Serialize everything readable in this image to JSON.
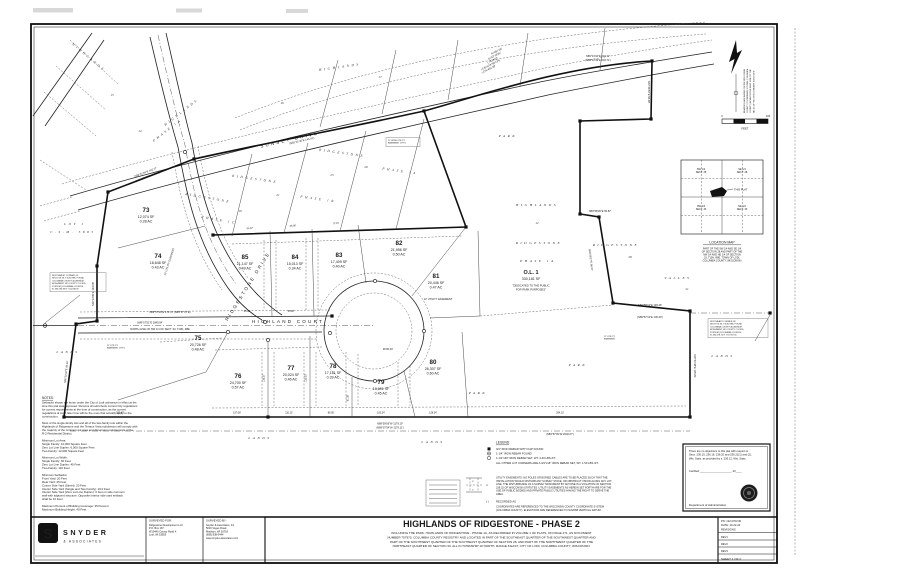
{
  "doc": {
    "type_label": "Final Plat Survey Sheet"
  },
  "title_block": {
    "logo": {
      "letter": "S",
      "name": "SNYDER",
      "sub": "& ASSOCIATES"
    },
    "surveyed_for": {
      "label": "SURVEYED FOR:",
      "lines": [
        "Ridgestone Development LLC",
        "P.O.  Box 167",
        "W10440 County Road K",
        "Lodi, WI 53555"
      ]
    },
    "surveyed_by": {
      "label": "SURVEYED BY:",
      "lines": [
        "Snyder & Associates, Inc.",
        "5010 Voges Road",
        "Madison, WI 53718",
        "(608) 838-0444",
        "www.snyder-associates.com"
      ]
    },
    "title": "HIGHLANDS OF RIDGESTONE - PHASE 2",
    "description_lines": [
      "INCLUDING THE PARK, HIGHLANDS OF RIDGESTONE - PHASE 1A, AS RECORDED IN VOLUME 1 OF PLATS, ON PAGE 271, AS DOCUMENT",
      "NUMBER 757970, COLUMBIA COUNTY REGISTRY AND LOCATED IN PART OF THE SOUTHEAST QUARTER OF THE SOUTHWEST QUARTER AND",
      "PART OF THE SOUTHWEST QUARTER OF THE SOUTHEAST QUARTER OF SECTION 28, AND PART OF THE NORTHWEST QUARTER OF THE",
      "NORTHEAST QUARTER OF SECTION 33, ALL IN TOWNSHIP 10 NORTH, RANGE 8 EAST, CITY OF LODI, COLUMBIA COUNTY, WISCONSIN."
    ],
    "info": {
      "pn": "PN: 122.0703.30",
      "date": "DATE: 10-22-24",
      "revisions_label": "REVISIONS",
      "revs": [
        "REV1",
        "REV2",
        "REV3"
      ],
      "sheet": "SHEET 1 OF 2"
    }
  },
  "certification": {
    "body_lines": [
      "There are no objections to this plat with respect to",
      "Secs. 236.15, 236.16, 236.20 and 236.21(1) and (2),",
      "Wis. Stats. as provided by s. 236.12, Wis. Stats."
    ],
    "certified_label": "Certified",
    "certified_blank": "_____________________, 20____",
    "agency": "Department of Administration"
  },
  "legend": {
    "title": "LEGEND:",
    "items": [
      {
        "symbol": "filled-square",
        "text": "3/4\" IRON REBAR WITH CAP FOUND"
      },
      {
        "symbol": "bullseye",
        "text": "1-1/4\" IRON REBAR FOUND"
      },
      {
        "symbol": "open-circle",
        "text": "1-1/4\"x30\" IRON REBAR SET, WT. 4.30 LBS./FT."
      },
      {
        "symbol": "none",
        "text": "ALL OTHER LOT CORNERS ARE A 3/4\"x18\" IRON REBAR SET, WT. 1.50 LBS./FT."
      }
    ],
    "easement_note_lines": [
      "UTILITY EASEMENTS: NO POLES OR BURIED CABLES ARE TO BE PLACED SUCH THAT THE",
      "INSTALLATION WOULD DISTURB ANY SURVEY STAKE, OR OBSTRUCT VISION ALONG ANY LOT",
      "LINE. THE DISTURBANCE OF A SURVEY MONUMENT BY ANYONE IS A VIOLATION OF SECTION",
      "236.32 OF WISCONSIN STATUTES. UTILITY EASEMENTS AS HEREIN SET FORTH ARE FOR THE",
      "USE OF PUBLIC BODIES AND PRIVATE PUBLIC UTILITIES HAVING THE RIGHT TO SERVE THE",
      "AREA."
    ],
    "recorded_symbol": "(    )",
    "recorded_as": "RECORDED AS",
    "datum_lines": [
      "COORDINATES ARE REFERENCED TO THE WISCONSIN COUNTY COORDINATE SYSTEM",
      "(COLUMBIA COUNTY). ELEVATIONS ARE REFERENCED TO NAVD88 VERTICAL DATUM."
    ],
    "sketch_dims": [
      "6'",
      "6'",
      "12'"
    ]
  },
  "notes": {
    "title": "NOTES:",
    "lines": [
      "Setbacks shown are those under the City of Lodi ordinance in effect at the",
      "time this plat was approved. Persons should check current City regulations",
      "for current requirements at the time of construction, as the current",
      "regulations at such later time will be the ones that actually apply to the",
      "construction.",
      "",
      "Most of the single-family lots and all of the two-family lots within the",
      "Highlands of Ridgestone and the Terrace Vista subdivision will comply with",
      "the majority of the minimum lot area and dimension requirements of the",
      "R-2 Residential District.",
      "",
      "Minimum Lot Area:",
      "      Single Family: 10,000 Square Feet",
      "      Zero Lot Line Duplex: 6,000 Square Feet",
      "      Two-Family: 12,000 Square Feet",
      "",
      "Minimum Lot Width:",
      "      Single Family: 60 Feet",
      "      Zero Lot Line Duplex: 40 Feet",
      "      Two-Family: 110 Feet",
      "",
      "Minimum Setbacks:",
      "      Front Yard: 20 Feet",
      "      Rear Yard: 25 Feet",
      "      Corner Side Yard (Street): 20 Feet",
      "      Interior Side Yard (Single and Two Family): 10.0 Feet",
      "      Interior Side Yard (Zero Lot Line Duplex): 0 feet on side common",
      "      wall with adjacent structure. Opposite interior side yard setback",
      "      shall be 10 Feet",
      "",
      "Maximum Percent of Building Coverage: 35 Percent",
      "Maximum Building Height: 40 Feet"
    ]
  },
  "location_map": {
    "title": "LOCATION MAP",
    "cells": [
      {
        "l1": "SW 1/4",
        "l2": "SECT. 28"
      },
      {
        "l1": "SE 1/4",
        "l2": "SECT. 28"
      },
      {
        "l1": "NW 1/4",
        "l2": "SECT. 33"
      },
      {
        "l1": "NE 1/4",
        "l2": "SECT. 33"
      }
    ],
    "this_plat": "THIS PLAT",
    "caption_lines": [
      "PART OF THE SW 1/4 AND SE 1/4",
      "OF SECTION 28 AND PART OF THE",
      "NW 1/4 AND NE 1/4 OF SECTION",
      "33, T10N, R8E, TOWN OF LODI,",
      "COLUMBIA COUNTY, WISCONSIN"
    ]
  },
  "north": {
    "note_lines": [
      "BEARINGS ARE BASED ON THE WISCONSIN",
      "COUNTY COORDINATE SYSTEM (COLUMBIA",
      "COUNTY) IN WHICH THE EAST LINE OF THE",
      "NE 1/4 OF SECTION 33 BEARS S00°21'48\"E"
    ],
    "scale_zero": "0",
    "scale_hundred": "100",
    "scale_unit": "FEET"
  },
  "map": {
    "streets": [
      "SUNSET DRIVE",
      "RIDGESTONE DRIVE",
      "HIGHLAND COURT"
    ],
    "lots": [
      {
        "num": "73",
        "sf": "12,074 SF",
        "ac": "0.28 AC",
        "x": 146,
        "y": 212
      },
      {
        "num": "74",
        "sf": "18,648 SF",
        "ac": "0.43 AC",
        "x": 158,
        "y": 258
      },
      {
        "num": "75",
        "sf": "20,726 SF",
        "ac": "0.48 AC",
        "x": 198,
        "y": 340
      },
      {
        "num": "76",
        "sf": "24,700 SF",
        "ac": "0.57 AC",
        "x": 238,
        "y": 378
      },
      {
        "num": "77",
        "sf": "20,024 SF",
        "ac": "0.46 AC",
        "x": 291,
        "y": 370
      },
      {
        "num": "78",
        "sf": "17,181 SF",
        "ac": "0.39 AC",
        "x": 333,
        "y": 368
      },
      {
        "num": "79",
        "sf": "19,691 SF",
        "ac": "0.45 AC",
        "x": 381,
        "y": 384
      },
      {
        "num": "80",
        "sf": "26,307 SF",
        "ac": "0.60 AC",
        "x": 433,
        "y": 364
      },
      {
        "num": "81",
        "sf": "20,446 SF",
        "ac": "0.47 AC",
        "x": 436,
        "y": 278
      },
      {
        "num": "82",
        "sf": "21,956 SF",
        "ac": "0.50 AC",
        "x": 399,
        "y": 245
      },
      {
        "num": "83",
        "sf": "17,409 SF",
        "ac": "0.40 AC",
        "x": 339,
        "y": 257
      },
      {
        "num": "84",
        "sf": "15,013 SF",
        "ac": "0.34 AC",
        "x": 295,
        "y": 259
      },
      {
        "num": "85",
        "sf": "21,147 SF",
        "ac": "0.49 AC",
        "x": 245,
        "y": 259
      }
    ],
    "outlot": {
      "num": "O.L. 1",
      "sf": "330,181 SF",
      "note1": "\"DEDICATED TO THE PUBLIC",
      "note2": "FOR PARK PURPOSES\"",
      "x": 531,
      "y": 274
    },
    "spread_labels": [
      {
        "t": "SUNSET DRIVE",
        "x": 290,
        "y": 141,
        "r": -13,
        "st": "street"
      },
      {
        "t": "RIDGESTONE DRIVE",
        "x": 249,
        "y": 287,
        "r": -58,
        "st": "street"
      },
      {
        "t": "HIGHLAND COURT",
        "x": 288,
        "y": 323,
        "r": 0,
        "st": "street"
      },
      {
        "t": "LOT 1",
        "x": 75,
        "y": 225,
        "r": 0,
        "st": "plat"
      },
      {
        "t": "C.S.M. 5885",
        "x": 73,
        "y": 233,
        "r": 0,
        "st": "plat"
      },
      {
        "t": "HIGHLANDS",
        "x": 88,
        "y": 58,
        "r": 40,
        "st": "plat"
      },
      {
        "t": "HIGHLANDS",
        "x": 182,
        "y": 113,
        "r": -38,
        "st": "plat"
      },
      {
        "t": "PHASE 1A",
        "x": 168,
        "y": 131,
        "r": -38,
        "st": "plat"
      },
      {
        "t": "14",
        "x": 140,
        "y": 132,
        "r": 0,
        "st": "num"
      },
      {
        "t": "15",
        "x": 112,
        "y": 96,
        "r": 0,
        "st": "num"
      },
      {
        "t": "HIGHLANDS",
        "x": 340,
        "y": 68,
        "r": -8,
        "st": "plat"
      },
      {
        "t": "16",
        "x": 282,
        "y": 104,
        "r": 0,
        "st": "num"
      },
      {
        "t": "17",
        "x": 380,
        "y": 78,
        "r": 0,
        "st": "num"
      },
      {
        "t": "RIDGESTONE",
        "x": 208,
        "y": 199,
        "r": 10,
        "st": "plat"
      },
      {
        "t": "PHASE 1C",
        "x": 219,
        "y": 221,
        "r": 10,
        "st": "plat"
      },
      {
        "t": "19",
        "x": 240,
        "y": 212,
        "r": 0,
        "st": "num"
      },
      {
        "t": "RIDGESTONE",
        "x": 255,
        "y": 180,
        "r": 8,
        "st": "plat"
      },
      {
        "t": "21",
        "x": 278,
        "y": 196,
        "r": 0,
        "st": "num"
      },
      {
        "t": "PHASE 1B",
        "x": 318,
        "y": 200,
        "r": 8,
        "st": "plat"
      },
      {
        "t": "25",
        "x": 332,
        "y": 176,
        "r": 0,
        "st": "num"
      },
      {
        "t": "RIDGESTONE",
        "x": 342,
        "y": 154,
        "r": 8,
        "st": "plat"
      },
      {
        "t": "26",
        "x": 366,
        "y": 168,
        "r": 0,
        "st": "num"
      },
      {
        "t": "PHASE 1A",
        "x": 400,
        "y": 172,
        "r": 8,
        "st": "plat"
      },
      {
        "t": "HIGHLANDS",
        "x": 537,
        "y": 206,
        "r": 0,
        "st": "plat"
      },
      {
        "t": "12",
        "x": 537,
        "y": 224,
        "r": 0,
        "st": "num"
      },
      {
        "t": "RIDGESTONE",
        "x": 539,
        "y": 244,
        "r": 0,
        "st": "plat"
      },
      {
        "t": "PHASE 1A",
        "x": 538,
        "y": 262,
        "r": 0,
        "st": "plat"
      },
      {
        "t": "RIDGESTONE",
        "x": 616,
        "y": 246,
        "r": 0,
        "st": "plat"
      },
      {
        "t": "28",
        "x": 630,
        "y": 258,
        "r": 0,
        "st": "num"
      },
      {
        "t": "VALLEY",
        "x": 678,
        "y": 279,
        "r": 0,
        "st": "plat"
      },
      {
        "t": "21",
        "x": 687,
        "y": 290,
        "r": 0,
        "st": "num"
      },
      {
        "t": "PARK",
        "x": 508,
        "y": 137,
        "r": 0,
        "st": "plat"
      },
      {
        "t": "PARK",
        "x": 478,
        "y": 394,
        "r": 0,
        "st": "plat"
      },
      {
        "t": "PARK",
        "x": 578,
        "y": 366,
        "r": 0,
        "st": "plat"
      },
      {
        "t": "LANDS",
        "x": 68,
        "y": 353,
        "r": 0,
        "st": "plat"
      },
      {
        "t": "LANDS",
        "x": 260,
        "y": 439,
        "r": 0,
        "st": "plat"
      },
      {
        "t": "LANDS",
        "x": 433,
        "y": 443,
        "r": 0,
        "st": "plat"
      },
      {
        "t": "LANDS",
        "x": 723,
        "y": 357,
        "r": 0,
        "st": "plat"
      }
    ],
    "annotations": [
      {
        "t": "R=467.00'",
        "x": 497,
        "y": 52,
        "r": -27
      },
      {
        "t": "Δ=53°18'25\"",
        "x": 495,
        "y": 56.5,
        "r": -27
      },
      {
        "t": "L=434.52'",
        "x": 493,
        "y": 61,
        "r": -27
      },
      {
        "t": "LCB=N78°58'13\"E",
        "x": 491,
        "y": 65.5,
        "r": -27
      },
      {
        "t": "LCH=434.39'",
        "x": 489,
        "y": 70,
        "r": -27
      },
      {
        "t": "N89°13'10\"E  204.77'",
        "x": 598,
        "y": 57,
        "r": 0
      },
      {
        "t": "(N89°13'49\"E  204.71')",
        "x": 598,
        "y": 61,
        "r": 0
      },
      {
        "t": "S00°46'50\"E  58.48'",
        "x": 648,
        "y": 92,
        "r": 90
      },
      {
        "t": "N89°58'45\"E  59.87'",
        "x": 600,
        "y": 212,
        "r": 0
      },
      {
        "t": "S09°39'27\"E  86.57'",
        "x": 590,
        "y": 260,
        "r": 83
      },
      {
        "t": "N89°58'14\"E  139.46'",
        "x": 650,
        "y": 306,
        "r": 0
      },
      {
        "t": "(N89°57'13\"E  139.40')",
        "x": 650,
        "y": 318,
        "r": 0
      },
      {
        "t": "S00°21'48\"E  105.81'",
        "x": 694,
        "y": 366,
        "r": 90
      },
      {
        "t": "N89°59'06\"W  1179.19'",
        "x": 390,
        "y": 424.5,
        "r": 0
      },
      {
        "t": "(N89°57'54\"W  1179.11')",
        "x": 390,
        "y": 428.5,
        "r": 0
      },
      {
        "t": "(S89°57'09\"W  2640.07')",
        "x": 560,
        "y": 435,
        "r": 0
      },
      {
        "t": "N00°13'35\"E  134.58'",
        "x": 94,
        "y": 294,
        "r": -90
      },
      {
        "t": "N06°23'42\"E  95.26'",
        "x": 67,
        "y": 372,
        "r": -84
      },
      {
        "t": "N58°31'04\"E  102.77'",
        "x": 146,
        "y": 173,
        "r": -21
      },
      {
        "t": "(N58°30'57\"E  102.71')",
        "x": 148,
        "y": 177.5,
        "r": -21
      },
      {
        "t": "N65°21'18\"E  145.40'",
        "x": 300,
        "y": 137,
        "r": -13
      },
      {
        "t": "(N65°21'30\"E  145.42')",
        "x": 302,
        "y": 141.5,
        "r": -13
      },
      {
        "t": "N89°57'29\"E  170.72'  (N89°57'07\"E)",
        "x": 170,
        "y": 313,
        "r": 0
      },
      {
        "t": "N89°57'51\"E  2849.94'",
        "x": 150,
        "y": 323.5,
        "r": 0
      },
      {
        "t": "NORTH LINE OF NW 1/4 OF SECT. 33, T10N, R8E",
        "x": 160,
        "y": 330,
        "r": 0
      },
      {
        "t": "R=60.00'",
        "x": 388,
        "y": 350,
        "r": 0
      },
      {
        "t": "12' UTILITY EASEMENT",
        "x": 438,
        "y": 300,
        "r": 0
      },
      {
        "t": "12' UTILITY EASEMENT",
        "x": 170,
        "y": 262,
        "r": -72
      }
    ],
    "dims": [
      {
        "t": "64.97'",
        "x": 250,
        "y": 229,
        "r": -4
      },
      {
        "t": "65.00'",
        "x": 293,
        "y": 226.5,
        "r": -4
      },
      {
        "t": "72.15'",
        "x": 336,
        "y": 224,
        "r": -4
      },
      {
        "t": "65.00'",
        "x": 247,
        "y": 312,
        "r": 0
      },
      {
        "t": "65.00'",
        "x": 291,
        "y": 312,
        "r": 0
      },
      {
        "t": "192.40'",
        "x": 120,
        "y": 413.5,
        "r": 0
      },
      {
        "t": "157.08'",
        "x": 237,
        "y": 413.5,
        "r": 0
      },
      {
        "t": "110.15'",
        "x": 289,
        "y": 413.5,
        "r": 0
      },
      {
        "t": "86.00'",
        "x": 331,
        "y": 413.5,
        "r": 0
      },
      {
        "t": "100.24'",
        "x": 381,
        "y": 413.5,
        "r": 0
      },
      {
        "t": "128.34'",
        "x": 433,
        "y": 413.5,
        "r": 0
      },
      {
        "t": "264.10'",
        "x": 560,
        "y": 413.5,
        "r": 0
      },
      {
        "t": "135.27'",
        "x": 264.5,
        "y": 378,
        "r": -90
      },
      {
        "t": "132.00'",
        "x": 306.5,
        "y": 378,
        "r": -90
      },
      {
        "t": "81.05'",
        "x": 348.5,
        "y": 398,
        "r": -90
      }
    ],
    "corner_notes": [
      {
        "x": 52,
        "y": 276,
        "w": 56,
        "h": 19,
        "box": true,
        "lines": [
          "NORTHWEST CORNER OF",
          "SECTION 33, T10N, R8E, FOUND",
          "COLUMBIA COUNTY ALUMINUM",
          "MONUMENT, WI COUNTY COORD.",
          "SYSTEM (COLUMBIA) COORDS:",
          "N: 480,596.83  E: 704,948.58"
        ]
      },
      {
        "x": 710,
        "y": 322,
        "w": 60,
        "h": 19,
        "box": true,
        "lines": [
          "NORTHEAST CORNER OF",
          "SECTION 33, T10N, R8E, FOUND",
          "COLUMBIA COUNTY ALUMINUM",
          "MONUMENT, WI COUNTY COORD.",
          "SYSTEM (COLUMBIA) COORDS:",
          "N: 480,578.75  E: 707,787.56"
        ]
      },
      {
        "x": 388,
        "y": 141,
        "w": 34,
        "h": 9,
        "box": true,
        "lines": [
          "12' WIDE UTILITY",
          "EASEMENT (TYP.)"
        ]
      },
      {
        "x": 604,
        "y": 337,
        "w": 0,
        "h": 0,
        "box": false,
        "lines": [
          "12' UTILITY",
          "EASEMENT"
        ]
      },
      {
        "x": 107,
        "y": 346,
        "w": 0,
        "h": 0,
        "box": false,
        "lines": [
          "12' UTILITY",
          "EASEMENT (TYP.)"
        ]
      }
    ]
  }
}
